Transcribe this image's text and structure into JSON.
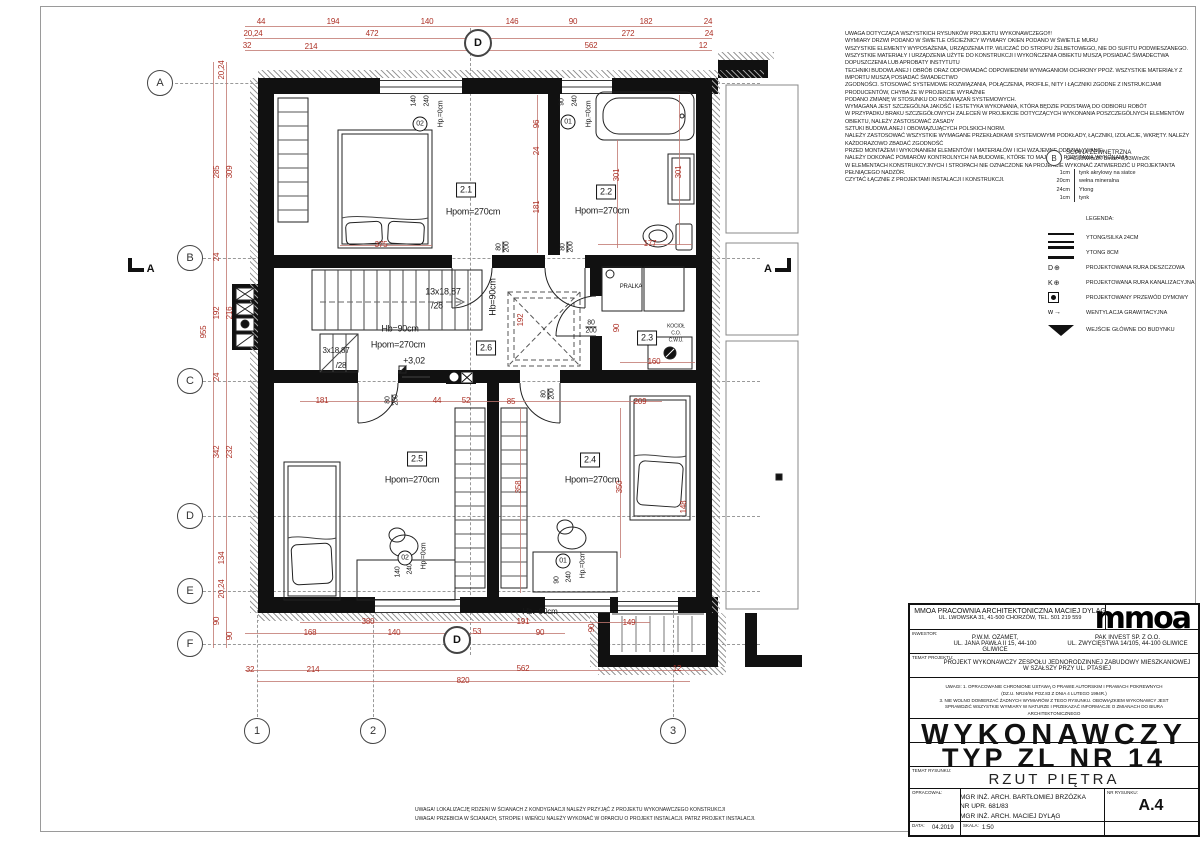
{
  "sheet": {
    "section_label": "A"
  },
  "notes_top": {
    "lines": [
      "UWAGA DOTYCZĄCA WSZYSTKICH RYSUNKÓW PROJEKTU WYKONAWCZEGO!!!",
      "WYMIARY DRZWI PODANO W ŚWIETLE OŚCIEŻNICY WYMIARY OKIEN PODANO W ŚWIETLE MURU",
      "WSZYSTKIE ELEMENTY WYPOSAŻENIA, URZĄDZENIA ITP. WLICZAĆ DO STROPU ŻELBETOWEGO, NIE DO SUFITU PODWIESZANEGO.",
      "WSZYSTKIE MATERIAŁY I URZĄDZENIA UŻYTE DO KONSTRUKCJI I WYKOŃCZENIA OBIEKTU MUSZĄ POSIADAĆ ŚWIADECTWA DOPUSZCZENIA LUB APROBATY INSTYTUTU",
      "TECHNIKI BUDOWLANEJ I OBRÓB ORAZ ODPOWIADAĆ ODPOWIEDNIM WYMAGANIOM OCHRONY PPOŻ. WSZYSTKIE MATERIAŁY Z IMPORTU MUSZĄ POSIADAĆ ŚWIADECTWO",
      "ZGODNOŚCI. STOSOWAĆ SYSTEMOWE ROZWIĄZANIA, POŁĄCZENIA, PROFILE, NITY I ŁĄCZNIKI ZGODNE Z INSTRUKCJAMI PRODUCENTÓW, CHYBA ŻE W PROJEKCIE WYRAŹNIE",
      "PODANO ZMIANĘ W STOSUNKU DO ROZWIĄZAŃ SYSTEMOWYCH.",
      "WYMAGANA JEST SZCZEGÓLNA JAKOŚĆ I ESTETYKA WYKONANIA, KTÓRA BĘDZIE PODSTAWĄ DO ODBIORU ROBÓT",
      "W PRZYPADKU BRAKU SZCZEGÓŁOWYCH ZALECEŃ W PROJEKCIE DOTYCZĄCYCH WYKONANIA POSZCZEGÓLNYCH ELEMENTÓW OBIEKTU, NALEŻY ZASTOSOWAĆ ZASADY",
      "SZTUKI BUDOWLANEJ I OBOWIĄZUJĄCYCH POLSKICH NORM.",
      "NALEŻY ZASTOSOWAĆ WSZYSTKIE WYMAGANE PRZEKŁADKAMI SYSTEMOWYMI PODKŁADY, ŁĄCZNIKI, IZOLACJE, WKRĘTY. NALEŻY KAŻDORAZOWO ZBADAĆ ZGODNOŚĆ",
      "PRZED MONTAŻEM I WYKONANIEM ELEMENTÓW I MATERIAŁÓW I ICH WZAJEMNE ODDZIAŁYWANIE.",
      "NALEŻY DOKONAĆ POMIARÓW KONTROLNYCH NA BUDOWIE, KTÓRE TO MAJĄ BYĆ PODSTAWĄ WYKONANIA.",
      "W ELEMENTACH KONSTRUKCYJNYCH I STROPACH NIE OZNACZONE NA PROJEKCIE WYKONAĆ ZATWIERDZIĆ U PROJEKTANTA PEŁNIĄCEGO NADZÓR.",
      "CZYTAĆ ŁĄCZNIE Z PROJEKTAMI INSTALACJI I KONSTRUKCJI."
    ]
  },
  "wall_detail": {
    "marker": "B",
    "title": "ŚCIANA ZEWNĘTRZNA",
    "u_value": "U=0,19W/m2K Umax=0,23W/m2K",
    "layers": [
      {
        "t": "1cm",
        "d": "tynk akrylowy na siatce"
      },
      {
        "t": "20cm",
        "d": "wełna mineralna"
      },
      {
        "t": "24cm",
        "d": "Ytong"
      },
      {
        "t": "1cm",
        "d": "tynk"
      }
    ]
  },
  "legend": {
    "title": "LEGENDA:",
    "items": [
      {
        "label": "YTONG/SILKA 24CM"
      },
      {
        "label": "YTONG 8CM"
      },
      {
        "label": "PROJEKTOWANA RURA DESZCZOWA"
      },
      {
        "label": "PROJEKTOWANA RURA KANALIZACYJNA"
      },
      {
        "label": "PROJEKTOWANY PRZEWÓD DYMOWY"
      },
      {
        "label": "WENTYLACJA GRAWITACYJNA"
      },
      {
        "label": "WEJŚCIE GŁÓWNE DO BUDYNKU"
      }
    ],
    "sym_deszczowa": "D⊕",
    "sym_kanalizacyjna": "K⊕",
    "sym_wentylacja": "w→"
  },
  "plan": {
    "labels": [
      {
        "t": "44",
        "x": 261,
        "y": 22
      },
      {
        "t": "194",
        "x": 333,
        "y": 22
      },
      {
        "t": "140",
        "x": 427,
        "y": 22
      },
      {
        "t": "146",
        "x": 512,
        "y": 22
      },
      {
        "t": "90",
        "x": 573,
        "y": 22
      },
      {
        "t": "182",
        "x": 646,
        "y": 22
      },
      {
        "t": "24",
        "x": 708,
        "y": 22
      },
      {
        "t": "20,24",
        "x": 253,
        "y": 34
      },
      {
        "t": "472",
        "x": 372,
        "y": 34
      },
      {
        "t": "272",
        "x": 628,
        "y": 34
      },
      {
        "t": "24",
        "x": 709,
        "y": 34
      },
      {
        "t": "32",
        "x": 247,
        "y": 46
      },
      {
        "t": "214",
        "x": 311,
        "y": 47
      },
      {
        "t": "562",
        "x": 591,
        "y": 46
      },
      {
        "t": "12",
        "x": 703,
        "y": 46
      },
      {
        "t": "20,24",
        "x": 222,
        "y": 70,
        "r": 1
      },
      {
        "t": "285",
        "x": 217,
        "y": 172,
        "r": 1
      },
      {
        "t": "309",
        "x": 230,
        "y": 172,
        "r": 1
      },
      {
        "t": "24",
        "x": 217,
        "y": 257,
        "r": 1
      },
      {
        "t": "192",
        "x": 217,
        "y": 313,
        "r": 1
      },
      {
        "t": "216",
        "x": 230,
        "y": 313,
        "r": 1
      },
      {
        "t": "955",
        "x": 204,
        "y": 332,
        "r": 1
      },
      {
        "t": "24",
        "x": 217,
        "y": 377,
        "r": 1
      },
      {
        "t": "342",
        "x": 217,
        "y": 452,
        "r": 1
      },
      {
        "t": "232",
        "x": 230,
        "y": 452,
        "r": 1
      },
      {
        "t": "134",
        "x": 222,
        "y": 558,
        "r": 1
      },
      {
        "t": "20,24",
        "x": 222,
        "y": 589,
        "r": 1
      },
      {
        "t": "90",
        "x": 217,
        "y": 621,
        "r": 1
      },
      {
        "t": "90",
        "x": 230,
        "y": 636,
        "r": 1
      },
      {
        "t": "380",
        "x": 368,
        "y": 622
      },
      {
        "t": "191",
        "x": 523,
        "y": 622
      },
      {
        "t": "149",
        "x": 629,
        "y": 623
      },
      {
        "t": "168",
        "x": 310,
        "y": 633
      },
      {
        "t": "140",
        "x": 394,
        "y": 633
      },
      {
        "t": "53",
        "x": 477,
        "y": 632
      },
      {
        "t": "90",
        "x": 540,
        "y": 633
      },
      {
        "t": "32",
        "x": 250,
        "y": 670
      },
      {
        "t": "214",
        "x": 313,
        "y": 670
      },
      {
        "t": "562",
        "x": 523,
        "y": 669
      },
      {
        "t": "12",
        "x": 677,
        "y": 669
      },
      {
        "t": "820",
        "x": 463,
        "y": 681
      },
      {
        "t": "90",
        "x": 592,
        "y": 628,
        "r": 1
      },
      {
        "t": "375",
        "x": 381,
        "y": 245
      },
      {
        "t": "177",
        "x": 650,
        "y": 244
      },
      {
        "t": "301",
        "x": 617,
        "y": 175,
        "r": 1
      },
      {
        "t": "301",
        "x": 679,
        "y": 172,
        "r": 1
      },
      {
        "t": "96",
        "x": 537,
        "y": 124,
        "r": 1
      },
      {
        "t": "24",
        "x": 537,
        "y": 151,
        "r": 1
      },
      {
        "t": "181",
        "x": 537,
        "y": 207,
        "r": 1
      },
      {
        "t": "192",
        "x": 521,
        "y": 320,
        "r": 1
      },
      {
        "t": "90",
        "x": 617,
        "y": 328,
        "r": 1
      },
      {
        "t": "160",
        "x": 654,
        "y": 362
      },
      {
        "t": "181",
        "x": 322,
        "y": 401
      },
      {
        "t": "44",
        "x": 437,
        "y": 401
      },
      {
        "t": "52",
        "x": 466,
        "y": 401
      },
      {
        "t": "85",
        "x": 511,
        "y": 402
      },
      {
        "t": "209",
        "x": 640,
        "y": 402
      },
      {
        "t": "358",
        "x": 519,
        "y": 487,
        "r": 1
      },
      {
        "t": "350",
        "x": 620,
        "y": 487,
        "r": 1
      },
      {
        "t": "148",
        "x": 684,
        "y": 507,
        "r": 1
      },
      {
        "t": "Hpom=270cm",
        "x": 473,
        "y": 212,
        "c": "blk",
        "s": 9
      },
      {
        "t": "Hpom=270cm",
        "x": 602,
        "y": 211,
        "c": "blk",
        "s": 9
      },
      {
        "t": "Hpom=270cm",
        "x": 412,
        "y": 480,
        "c": "blk",
        "s": 9
      },
      {
        "t": "Hpom=270cm",
        "x": 592,
        "y": 480,
        "c": "blk",
        "s": 9
      },
      {
        "t": "Hpom=270cm",
        "x": 398,
        "y": 345,
        "c": "blk",
        "s": 9
      },
      {
        "t": "Hb=90cm",
        "x": 400,
        "y": 329,
        "c": "blk",
        "s": 9
      },
      {
        "t": "Hb=90cm",
        "x": 493,
        "y": 297,
        "r": 1,
        "c": "blk",
        "s": 9
      },
      {
        "t": "Hb.=90cm",
        "x": 540,
        "y": 612,
        "c": "blk",
        "s": 8
      },
      {
        "t": "13x18,87",
        "x": 443,
        "y": 292,
        "c": "blk",
        "s": 9
      },
      {
        "t": "/28",
        "x": 437,
        "y": 306,
        "c": "blk",
        "s": 9
      },
      {
        "t": "3x18,87",
        "x": 336,
        "y": 351,
        "c": "blk",
        "s": 8
      },
      {
        "t": "/28",
        "x": 341,
        "y": 366,
        "c": "blk",
        "s": 8
      },
      {
        "t": "+3,02",
        "x": 414,
        "y": 361,
        "c": "blk",
        "s": 9
      },
      {
        "t": "PRALKA",
        "x": 631,
        "y": 287,
        "c": "blk",
        "s": 6
      },
      {
        "t": "KOCIOŁ",
        "x": 676,
        "y": 327,
        "c": "blk",
        "s": 5
      },
      {
        "t": "C.O.",
        "x": 676,
        "y": 334,
        "c": "blk",
        "s": 5
      },
      {
        "t": "C.W.U.",
        "x": 676,
        "y": 341,
        "c": "blk",
        "s": 5
      },
      {
        "t": "140",
        "x": 414,
        "y": 101,
        "r": 1,
        "c": "blk",
        "s": 7
      },
      {
        "t": "240",
        "x": 427,
        "y": 101,
        "r": 1,
        "c": "blk",
        "s": 7
      },
      {
        "t": "Hp.=0cm",
        "x": 441,
        "y": 114,
        "r": 1,
        "c": "blk",
        "s": 7
      },
      {
        "t": "90",
        "x": 562,
        "y": 102,
        "r": 1,
        "c": "blk",
        "s": 7
      },
      {
        "t": "240",
        "x": 575,
        "y": 101,
        "r": 1,
        "c": "blk",
        "s": 7
      },
      {
        "t": "Hp.=0cm",
        "x": 589,
        "y": 114,
        "r": 1,
        "c": "blk",
        "s": 7
      },
      {
        "t": "140",
        "x": 398,
        "y": 572,
        "r": 1,
        "c": "blk",
        "s": 7
      },
      {
        "t": "240",
        "x": 410,
        "y": 569,
        "r": 1,
        "c": "blk",
        "s": 7
      },
      {
        "t": "Hp.=0cm",
        "x": 424,
        "y": 556,
        "r": 1,
        "c": "blk",
        "s": 7
      },
      {
        "t": "90",
        "x": 557,
        "y": 580,
        "r": 1,
        "c": "blk",
        "s": 7
      },
      {
        "t": "240",
        "x": 569,
        "y": 577,
        "r": 1,
        "c": "blk",
        "s": 7
      },
      {
        "t": "Hp.=0cm",
        "x": 583,
        "y": 565,
        "r": 1,
        "c": "blk",
        "s": 7
      },
      {
        "t": "02",
        "x": 420,
        "y": 124,
        "c": "circ"
      },
      {
        "t": "01",
        "x": 568,
        "y": 122,
        "c": "circ"
      },
      {
        "t": "02",
        "x": 405,
        "y": 558,
        "c": "circ"
      },
      {
        "t": "01",
        "x": 563,
        "y": 561,
        "c": "circ"
      },
      {
        "t": "2.1",
        "x": 466,
        "y": 190,
        "c": "box"
      },
      {
        "t": "2.2",
        "x": 606,
        "y": 192,
        "c": "box"
      },
      {
        "t": "2.3",
        "x": 647,
        "y": 338,
        "c": "box"
      },
      {
        "t": "2.4",
        "x": 590,
        "y": 460,
        "c": "box"
      },
      {
        "t": "2.5",
        "x": 417,
        "y": 459,
        "c": "box"
      },
      {
        "t": "2.6",
        "x": 486,
        "y": 348,
        "c": "box"
      },
      {
        "t": "80|200",
        "x": 503,
        "y": 247,
        "r": 1,
        "c": "frac"
      },
      {
        "t": "80|200",
        "x": 567,
        "y": 247,
        "r": 1,
        "c": "frac"
      },
      {
        "t": "80|200",
        "x": 591,
        "y": 327,
        "c": "frac"
      },
      {
        "t": "80|200",
        "x": 392,
        "y": 400,
        "r": 1,
        "c": "frac"
      },
      {
        "t": "80|200",
        "x": 548,
        "y": 394,
        "r": 1,
        "c": "frac"
      }
    ],
    "bubbles": [
      {
        "t": "A",
        "x": 160,
        "y": 83
      },
      {
        "t": "B",
        "x": 190,
        "y": 258
      },
      {
        "t": "C",
        "x": 190,
        "y": 381
      },
      {
        "t": "D",
        "x": 190,
        "y": 516
      },
      {
        "t": "E",
        "x": 190,
        "y": 591
      },
      {
        "t": "F",
        "x": 190,
        "y": 644
      },
      {
        "t": "1",
        "x": 257,
        "y": 731
      },
      {
        "t": "2",
        "x": 373,
        "y": 731
      },
      {
        "t": "3",
        "x": 673,
        "y": 731
      },
      {
        "t": "D",
        "x": 478,
        "y": 43,
        "big": 1
      },
      {
        "t": "D",
        "x": 457,
        "y": 640,
        "big": 1
      }
    ]
  },
  "bottom_notes": {
    "lines": [
      "UWAGA! LOKALIZACJĘ RDZENI W ŚCIANACH Z KONDYGNACJI NALEŻY PRZYJĄĆ Z PROJEKTU WYKONAWCZEGO KONSTRUKCJI",
      "UWAGA! PRZEBICIA W ŚCIANACH, STROPIE I WIEŃCU NALEŻY WYKONAĆ W OPARCIU O PROJEKT INSTALACJI. PATRZ PROJEKT INSTALACJI."
    ]
  },
  "title_block": {
    "office_line1": "MMOA PRACOWNIA ARCHITEKTONICZNA MACIEJ DYLĄG",
    "office_line2": "UL. LWOWSKA 31, 41-500 CHORZÓW, TEL. 501 219 559",
    "logo": "mmoa",
    "investor_label": "INWESTOR:",
    "inv1_name": "P.W.M. OZAMET,",
    "inv1_addr": "UL. JANA PAWŁA II 15, 44-100 GLIWICE",
    "inv2_name": "PAK INVEST SP. Z O.O.",
    "inv2_addr": "UL. ZWYCIĘSTWA 14/105, 44-100 GLIWICE",
    "temat_label": "TEMAT PROJEKTU:",
    "temat_line1": "PROJEKT WYKONAWCZY ZESPOŁU JEDNORODZINNEJ ZABUDOWY MIESZKANIOWEJ",
    "temat_line2": "W SZAŁSZY PRZY UL. PTASIEJ",
    "uwagi": [
      "UWAGI: 1. OPRACOWANIE CHRONIONE USTAWĄ O PRAWIE AUTORSKIM I PRAWACH POKREWNYCH",
      "(DZ.U. NR24/94 POZ.83 Z DNIA 4 LUTEGO 1994R.)",
      "3. NIE WOLNO DOMIERZAĆ ŻADNYCH WYMIARÓW Z TEGO RYSUNKU. OBOWIĄZKIEM WYKONAWCY JEST",
      "SPRAWDZIĆ WSZYSTKIE WYMIARY W NATURZE I PRZEKAZAĆ INFORMACJE O ZMIANACH DO BIURA",
      "ARCHITEKTONICZNEGO"
    ],
    "big1": "WYKONAWCZY",
    "big2": "TYP ZL  NR  14",
    "temat_rys_label": "TEMAT RYSUNKU:",
    "temat_rys": "RZUT PIĘTRA",
    "oprac_label": "OPRACOWAŁ:",
    "authors": [
      "MGR INŻ. ARCH. BARTŁOMIEJ BRZÓZKA",
      "NR UPR. 681/83",
      "MGR INŻ. ARCH. MACIEJ DYLĄG"
    ],
    "nr_label": "NR RYSUNKU:",
    "nr": "A.4",
    "data_label": "DATA:",
    "data_value": "04.2019",
    "skala_label": "SKALA:",
    "skala_value": "1:50"
  }
}
